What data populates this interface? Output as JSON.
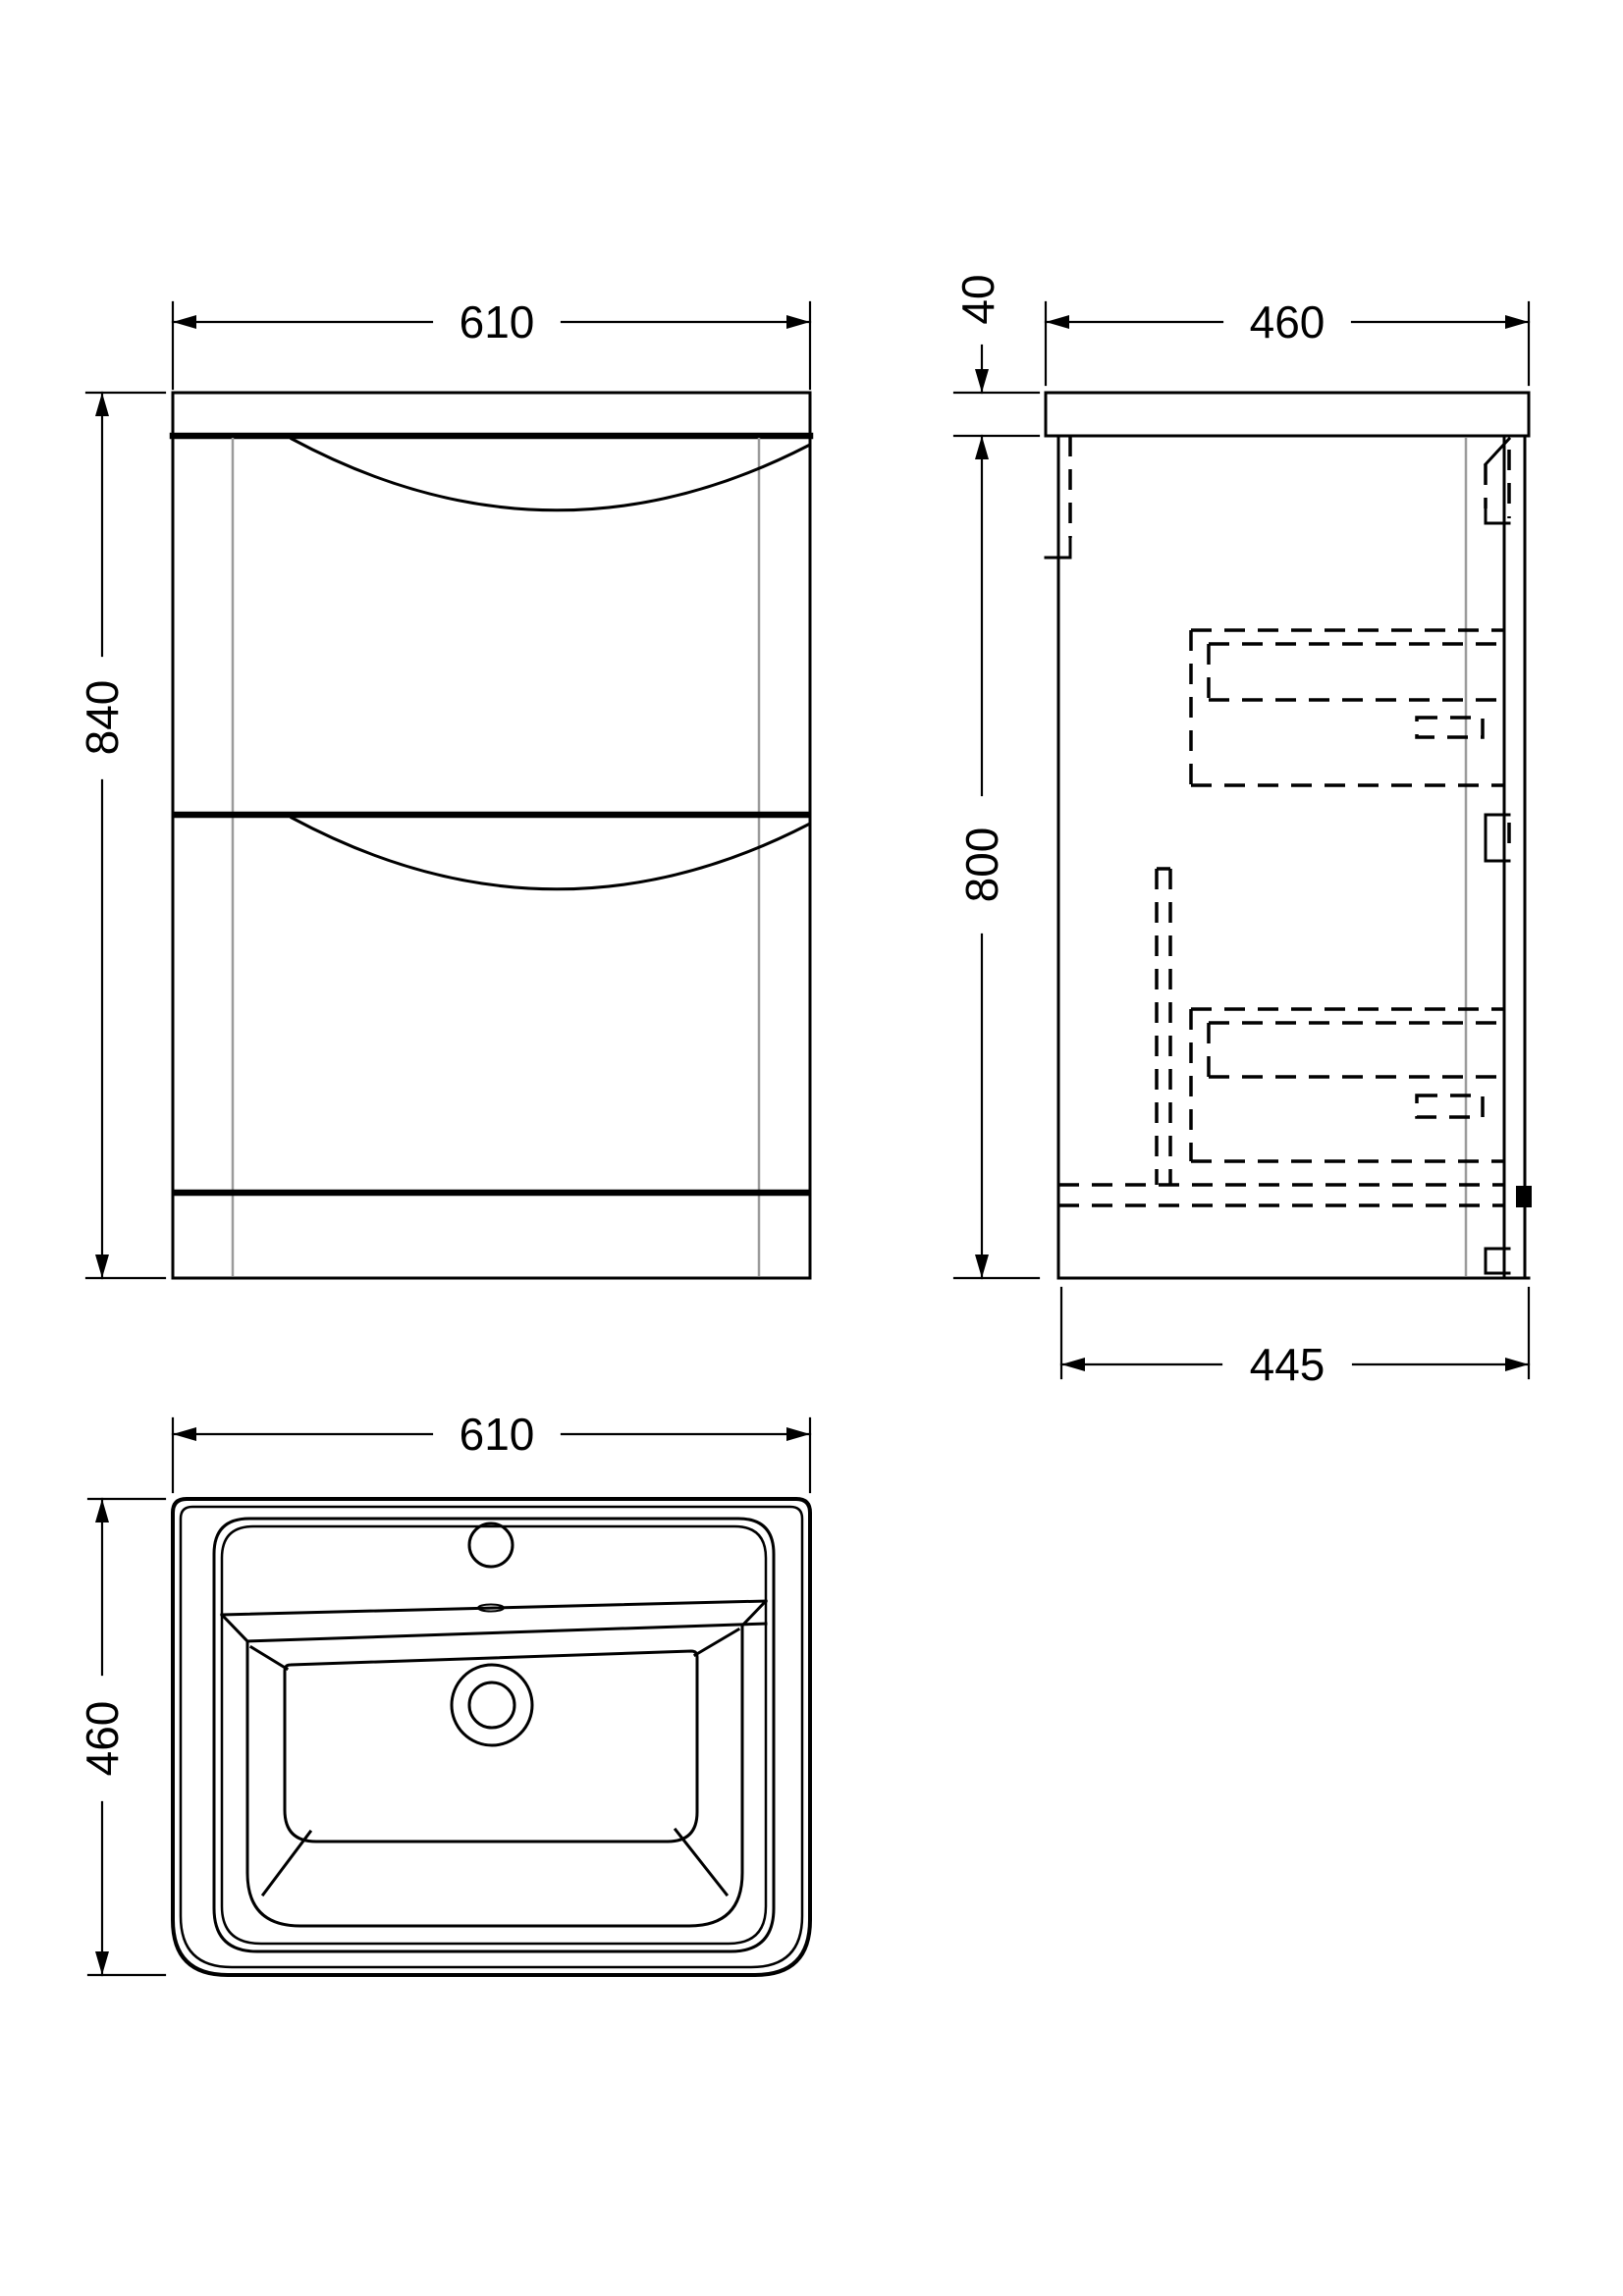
{
  "drawing_title": "vanity-unit-technical-drawing",
  "colors": {
    "line": "#000000",
    "hidden_gray": "#9b9b9b",
    "background": "#ffffff"
  },
  "views": {
    "front_elevation": {
      "width": "610",
      "height": "840"
    },
    "side_elevation": {
      "top_width": "460",
      "worktop_thickness": "40",
      "cabinet_height": "800",
      "base_depth": "445"
    },
    "basin_plan": {
      "width": "610",
      "depth": "460"
    }
  }
}
